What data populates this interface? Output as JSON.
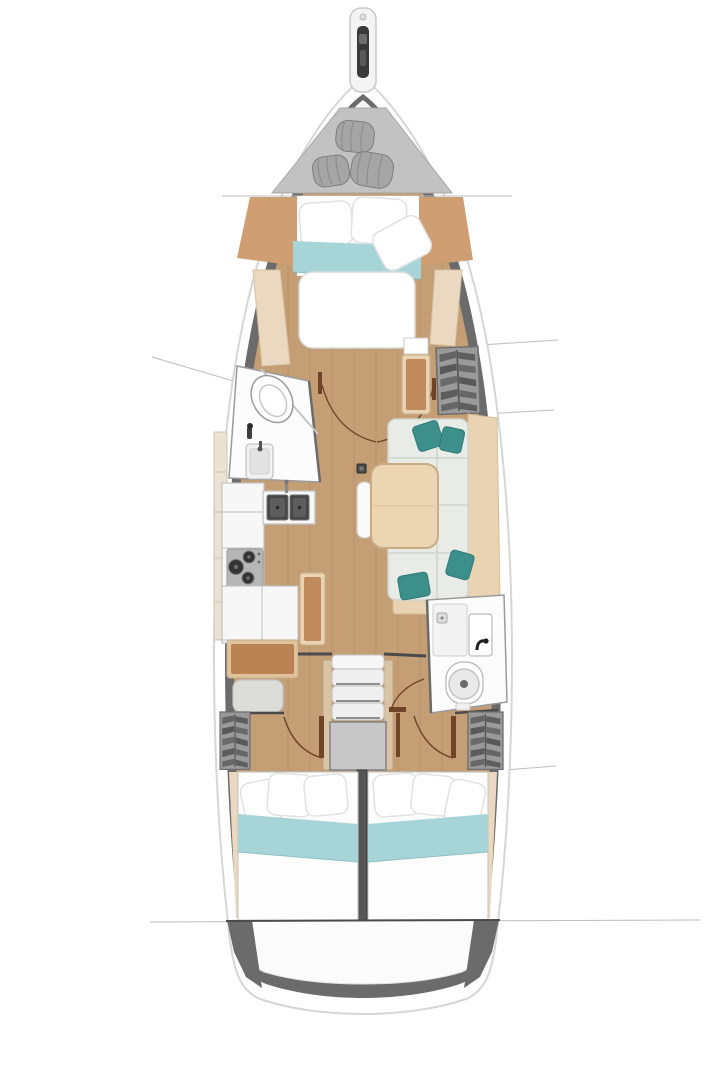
{
  "diagram": {
    "type": "yacht-interior-floor-plan",
    "view": "top-down",
    "orientation": "bow-up",
    "rooms": {
      "bow": {
        "name": "bow",
        "items": [
          "bowsprit-anchor-roller",
          "sail-locker",
          "sail-bag",
          "sail-bag",
          "sail-bag"
        ]
      },
      "forward_cabin": {
        "name": "forward-cabin",
        "items": [
          "double-bed",
          "pillow",
          "pillow",
          "pillow",
          "teal-bed-runner",
          "headboard-panel-port",
          "headboard-panel-starboard",
          "side-bench-port",
          "side-bench-starboard"
        ]
      },
      "forward_head": {
        "name": "forward-head",
        "items": [
          "toilet",
          "washbasin",
          "shower-mixer",
          "glass-partition"
        ]
      },
      "saloon": {
        "name": "saloon",
        "items": [
          "u-shaped-sofa",
          "accent-cushion",
          "accent-cushion",
          "accent-cushion",
          "accent-cushion",
          "dining-table",
          "stool-bench",
          "forward-bench",
          "floor-hatch",
          "hanging-locker"
        ]
      },
      "galley": {
        "name": "galley",
        "items": [
          "double-sink",
          "faucet",
          "three-burner-stove",
          "worktop",
          "lower-cabinet",
          "side-shelf"
        ]
      },
      "nav_station": {
        "name": "nav-station",
        "items": [
          "chart-desk",
          "seat",
          "tall-bench"
        ]
      },
      "companionway": {
        "name": "companionway",
        "items": [
          "entry-sill",
          "step",
          "step",
          "step",
          "engine-compartment",
          "handrail-port",
          "handrail-starboard"
        ]
      },
      "aft_head": {
        "name": "aft-head",
        "items": [
          "toilet",
          "washbasin",
          "shower-tray",
          "door-swing"
        ]
      },
      "aft_cabin_port": {
        "name": "aft-cabin-port",
        "items": [
          "double-bed",
          "pillow",
          "pillow",
          "pillow",
          "teal-bed-runner",
          "wardrobe",
          "door-swing"
        ]
      },
      "aft_cabin_starboard": {
        "name": "aft-cabin-starboard",
        "items": [
          "double-bed",
          "pillow",
          "pillow",
          "pillow",
          "teal-bed-runner",
          "wardrobe",
          "door-swing"
        ]
      },
      "stern": {
        "name": "stern",
        "items": [
          "transom-platform"
        ]
      }
    },
    "annotations": {
      "section_lines": 2,
      "callout_lines": 4
    }
  },
  "palette": {
    "bg": "#ffffff",
    "hull_stroke": "#d6d6d6",
    "hull_wall": "#6b6b6b",
    "deck_white": "#f6f6f6",
    "floor": "#c49e75",
    "plank": "#9c7a52",
    "locker": "#c2c2c2",
    "bag": "#a5a5a5",
    "bag_dark": "#7e7e7e",
    "bed_white": "#fdfdfd",
    "teal": "#a7d5d7",
    "teal_edge": "#8fc0c3",
    "panel_tan": "#cf9f73",
    "bench_wood": "#ead9c0",
    "trim_wood": "#e9d3b2",
    "cushion": "#e8ebe6",
    "cushion_seam": "#d0d5cf",
    "pillow_teal": "#3d8f8c",
    "table_wood": "#ecd5b3",
    "table_edge": "#c9ab84",
    "counter_white": "#f7f7f7",
    "furn_stroke": "#c2c2c2",
    "sink_dark": "#474747",
    "stove": "#b6b6b6",
    "burner": "#343434",
    "desk_brown": "#bb8354",
    "desk_frame": "#dec39d",
    "bench_brown": "#c08a5c",
    "seat_gray": "#dcdcd8",
    "wardrobe": "#9a9a9a",
    "wardrobe_dark": "#686868",
    "clothes": "#616161",
    "engine_box": "#c7c7c7",
    "step_white": "#efefef",
    "rail_wood": "#d8c3a4",
    "door_arc": "#6f4428",
    "wall_dark": "#4a4a4a",
    "line_gray": "#bdbdbd",
    "stern_white": "#fbfbfb"
  }
}
